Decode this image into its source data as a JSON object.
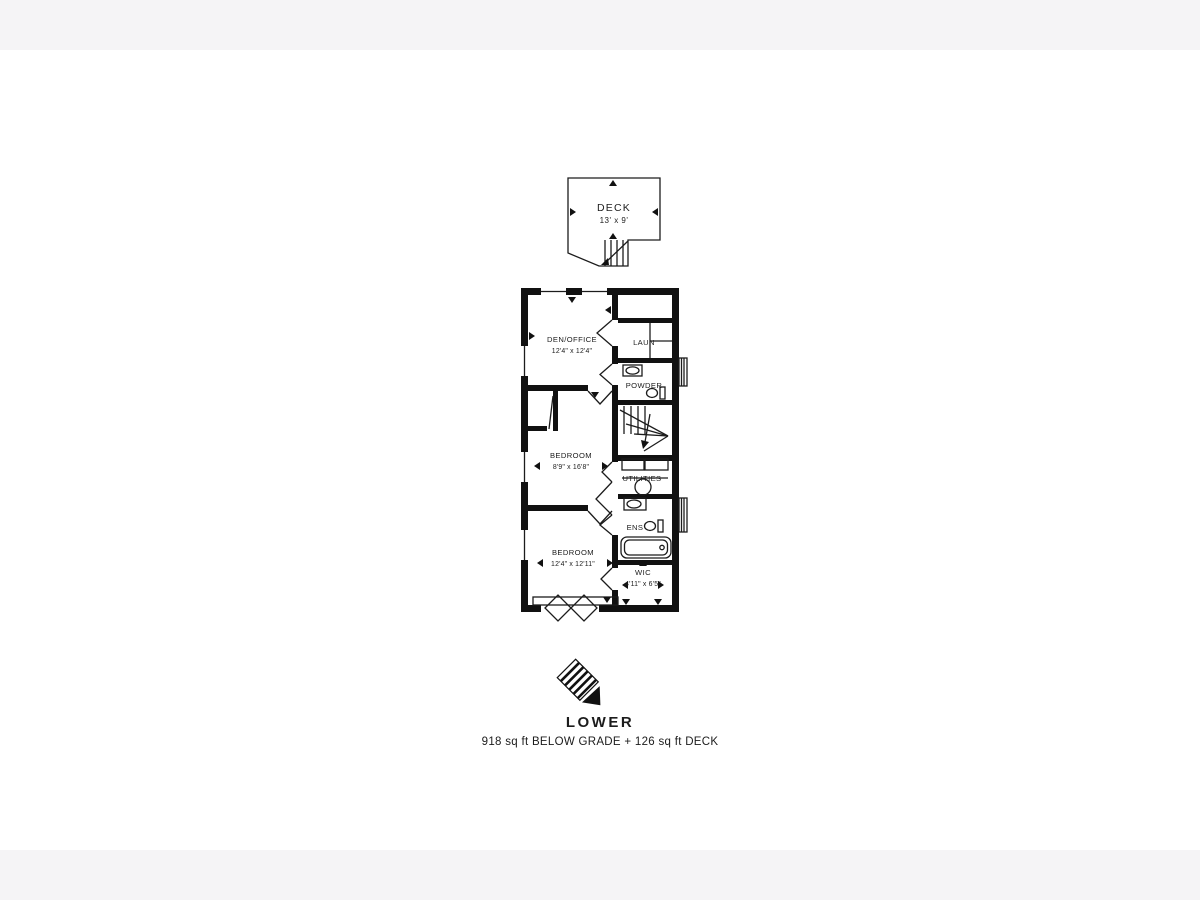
{
  "colors": {
    "background": "#ffffff",
    "letterbox_band": "#f5f4f6",
    "line": "#1c1c1c"
  },
  "deck": {
    "label": "DECK",
    "dims": "13' x 9'"
  },
  "rooms": {
    "den_office": {
      "label": "DEN/OFFICE",
      "dims": "12'4\" x 12'4\""
    },
    "laundry": {
      "label": "LAUN"
    },
    "powder": {
      "label": "POWDER"
    },
    "bedroom_mid": {
      "label": "BEDROOM",
      "dims": "8'9\" x 16'8\""
    },
    "utilities": {
      "label": "UTILITIES"
    },
    "ensuite": {
      "label": "ENS"
    },
    "bedroom_lower": {
      "label": "BEDROOM",
      "dims": "12'4\" x 12'11\""
    },
    "wic": {
      "label": "WIC",
      "dims": "4'11\" x 6'5\""
    }
  },
  "footer": {
    "title": "LOWER",
    "subtitle": "918 sq ft BELOW GRADE + 126 sq ft DECK"
  },
  "icons": {
    "logo": "striped-compass-logo",
    "stairs": "stairs-icon",
    "toilet": "toilet-icon",
    "sink": "sink-icon",
    "bathtub": "bathtub-icon",
    "water_tank": "water-tank-icon"
  }
}
